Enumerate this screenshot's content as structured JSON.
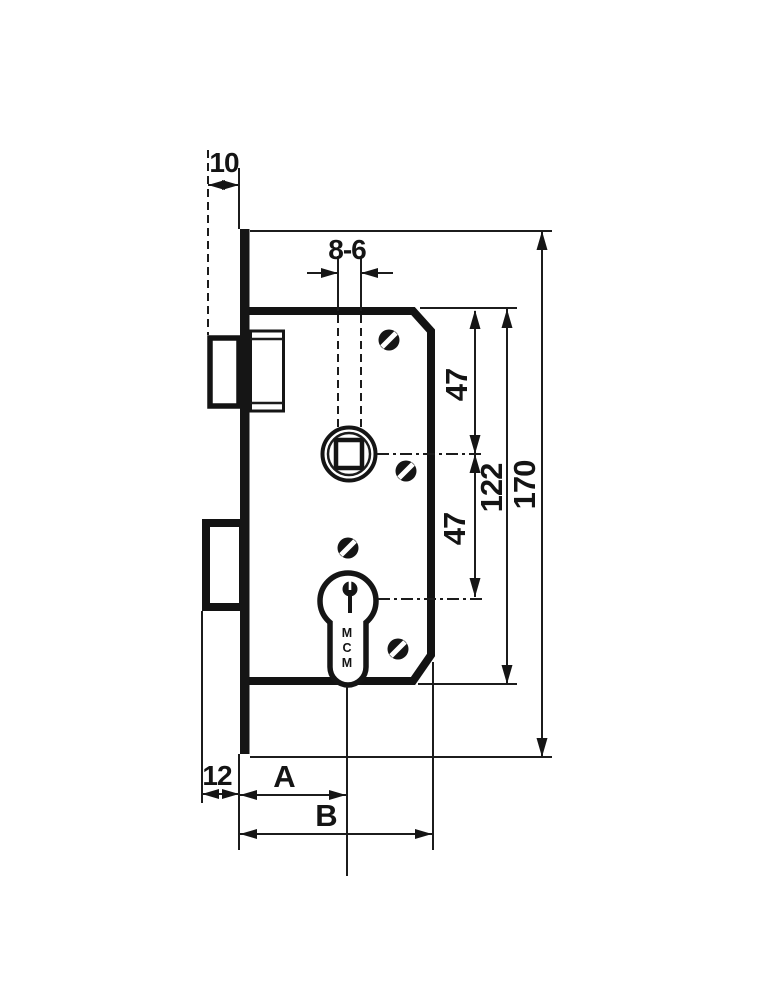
{
  "drawing": {
    "dim_latch_projection": "10",
    "dim_follower_square": "8-6",
    "dim_top_to_follower": "47",
    "dim_follower_to_cylinder": "47",
    "dim_case_height": "122",
    "dim_faceplate_length": "170",
    "dim_deadbolt_projection": "12",
    "dim_backset_label": "A",
    "dim_overall_depth_label": "B",
    "cylinder_brand_letters": [
      "M",
      "C",
      "M"
    ]
  },
  "colors": {
    "ink": "#151515",
    "paper": "#ffffff"
  }
}
